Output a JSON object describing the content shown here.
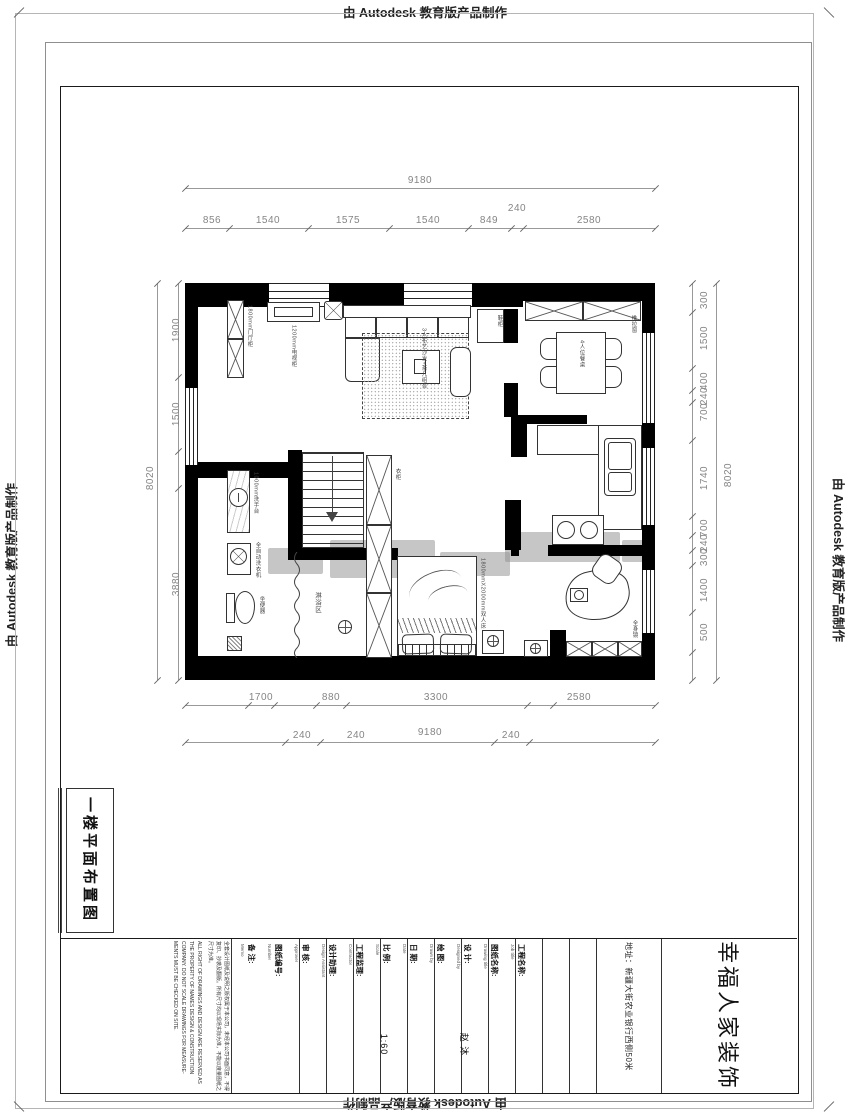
{
  "stamp": {
    "text": "由 Autodesk 教育版产品制作"
  },
  "drawing_label": "一楼平面布置图",
  "dims": {
    "top_total": "9180",
    "top": [
      "856",
      "1540",
      "1575",
      "1540",
      "849",
      "240",
      "2580"
    ],
    "bottom": [
      "1700",
      "880",
      "3300",
      "2580"
    ],
    "bottom2": [
      "240",
      "240",
      "9180",
      "240"
    ],
    "left": [
      "1900",
      "1500",
      "3880"
    ],
    "left_total": "8020",
    "right": [
      "300",
      "1500",
      "400",
      "240",
      "700",
      "1740",
      "700",
      "240",
      "300",
      "1400",
      "500"
    ],
    "right_total": "8020"
  },
  "plan": {
    "labels": {
      "entry_cabinet": "1800mm门厅柜",
      "tv_cabinet": "1200mm电视柜",
      "shoe": "鞋柜",
      "sofa": "3人布艺沙发+茶几组合",
      "dining": "4人位餐桌",
      "window": "推拉窗",
      "basin": "1000mm洗手台",
      "washer": "全自动洗衣机",
      "toilet": "坐便器",
      "shower": "淋浴区",
      "wardrobe": "衣柜",
      "bed": "1800mmX2000mm双人床",
      "mirror": "全身镜"
    }
  },
  "title_block": {
    "company": "幸福人家装饰",
    "address": "地址：新疆大街农业银行西侧50米",
    "fields": [
      {
        "label": "工程名称:",
        "sub": "Job title",
        "value": ""
      },
      {
        "label": "图纸名称:",
        "sub": "Drawing title",
        "value": ""
      },
      {
        "label": "设 计:",
        "sub": "Designed by",
        "value": "赵 沐"
      },
      {
        "label": "绘 图:",
        "sub": "Drawn by",
        "value": ""
      },
      {
        "label": "日 期:",
        "sub": "Date",
        "value": ""
      },
      {
        "label": "比 例:",
        "sub": "Scale",
        "value": "1:60"
      },
      {
        "label": "工程监理:",
        "sub": "Contractor",
        "value": ""
      },
      {
        "label": "设计助理:",
        "sub": "Design Assistant",
        "value": ""
      },
      {
        "label": "审 核:",
        "sub": "Approver",
        "value": ""
      },
      {
        "label": "图纸编号:",
        "sub": "Number",
        "value": ""
      },
      {
        "label": "备 注:",
        "sub": "Memo",
        "value": ""
      }
    ],
    "disclaimer_cn": "全套设计图纸及说明之版权属于本公司，未经本公司书面同意，不得复印、抄袭及翻版。所有尺寸均以现场实际为准，不能以度量图纸之尺寸为准。",
    "disclaimer_en": "ALL RIGHT OF DRAWINGS AND DESIGN ARE RESERVED AS THE PROPERTY OF NAMES DESIGN & CONSTRUCTION COMPANY. DO NOT SCALE DRAWINGS FOR MEASURE- MENTS MUST BE CHECKED ON SITE."
  }
}
